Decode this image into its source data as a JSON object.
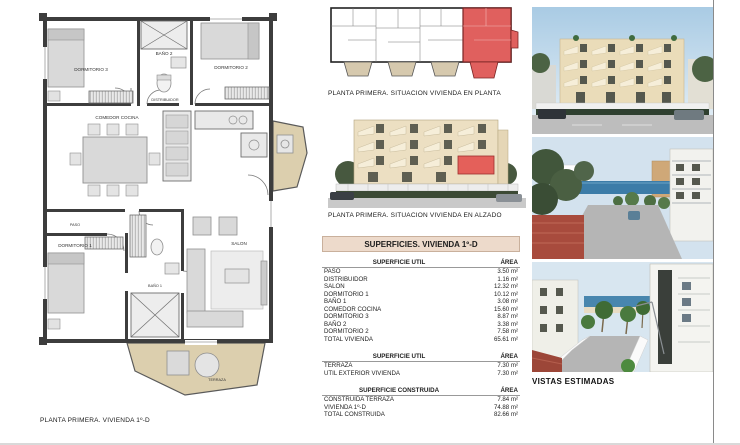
{
  "captions": {
    "situation_plan": "PLANTA PRIMERA. SITUACION VIVIENDA EN PLANTA",
    "elevation": "PLANTA PRIMERA. SITUACION VIVIENDA EN ALZADO",
    "floor_plan_footer": "PLANTA PRIMERA. VIVIENDA 1º-D",
    "vistas": "VISTAS ESTIMADAS"
  },
  "floor_plan_rooms": {
    "dormitorio3": "DORMITORIO 3",
    "bano2": "BAÑO 2",
    "dormitorio2": "DORMITORIO 2",
    "distribuidor": "DISTRIBUIDOR",
    "comedor_cocina": "COMEDOR COCINA",
    "paso": "PASO",
    "dormitorio1": "DORMITORIO 1",
    "bano1": "BAÑO 1",
    "salon": "SALON",
    "terraza": "TERRAZA"
  },
  "table": {
    "title": "SUPERFICIES. VIVIENDA 1º-D",
    "sections": [
      {
        "header": "SUPERFICIE UTIL",
        "area_header": "ÁREA",
        "rows": [
          {
            "label": "PASO",
            "value": "3.50 m²"
          },
          {
            "label": "DISTRIBUIDOR",
            "value": "1.16 m²"
          },
          {
            "label": "SALON",
            "value": "12.32 m²"
          },
          {
            "label": "DORMITORIO 1",
            "value": "10.12 m²"
          },
          {
            "label": "BAÑO 1",
            "value": "3.08 m²"
          },
          {
            "label": "COMEDOR COCINA",
            "value": "15.60 m²"
          },
          {
            "label": "DORMITORIO 3",
            "value": "8.87 m²"
          },
          {
            "label": "BAÑO 2",
            "value": "3.38 m²"
          },
          {
            "label": "DORMITORIO 2",
            "value": "7.58 m²"
          },
          {
            "label": "TOTAL VIVIENDA",
            "value": "65.61 m²"
          }
        ]
      },
      {
        "header": "SUPERFICIE UTIL",
        "area_header": "ÁREA",
        "rows": [
          {
            "label": "TERRAZA",
            "value": "7.30 m²"
          },
          {
            "label": "UTIL EXTERIOR VIVIENDA",
            "value": "7.30 m²"
          }
        ]
      },
      {
        "header": "SUPERFICIE CONSTRUIDA",
        "area_header": "ÁREA",
        "rows": [
          {
            "label": "CONSTRUIDA TERRAZA",
            "value": "7.84 m²"
          },
          {
            "label": "VIVIENDA 1º-D",
            "value": "74.88 m²"
          },
          {
            "label": "TOTAL CONSTRUIDA",
            "value": "82.66 m²"
          }
        ]
      }
    ]
  },
  "colors": {
    "highlight_red": "#e05c58",
    "terrace_beige": "#dccfae",
    "table_header_bg": "#eddacb",
    "wall_dark": "#3d3d3d"
  }
}
